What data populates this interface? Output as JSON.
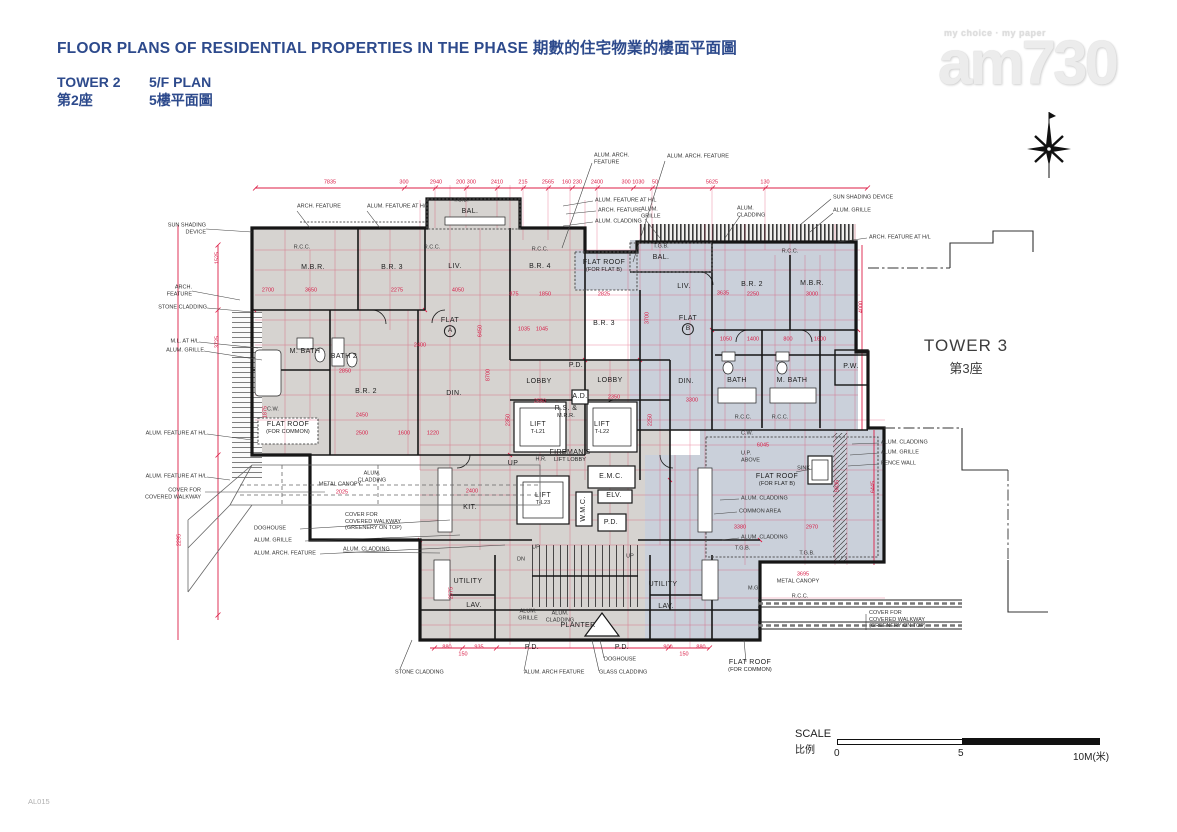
{
  "header": {
    "title": "FLOOR PLANS OF RESIDENTIAL PROPERTIES IN THE PHASE 期數的住宅物業的樓面平面圖",
    "tower_en": "TOWER 2",
    "plan_en": "5/F PLAN",
    "tower_zh": "第2座",
    "plan_zh": "5樓平面圖"
  },
  "logo": {
    "tagline": "my choice · my paper",
    "brand": "am730"
  },
  "tower3": {
    "en": "TOWER 3",
    "zh": "第3座"
  },
  "scale": {
    "label_en": "SCALE",
    "label_zh": "比例",
    "t0": "0",
    "t5": "5",
    "t10": "10M(米)"
  },
  "footer": {
    "code": "AL015"
  },
  "colors": {
    "accent_red": "#dc1e46",
    "title_blue": "#2d4a8c",
    "flat_a_fill": "#d6d3d0",
    "flat_b_fill": "#cad0da",
    "wall": "#161616"
  },
  "plan": {
    "rooms": [
      {
        "t": "M.B.R.",
        "x": 313,
        "y": 268
      },
      {
        "t": "B.R. 3",
        "x": 392,
        "y": 268
      },
      {
        "t": "LIV.",
        "x": 455,
        "y": 267
      },
      {
        "t": "BAL.",
        "x": 470,
        "y": 212
      },
      {
        "t": "B.R. 4",
        "x": 540,
        "y": 267
      },
      {
        "t": "FLAT",
        "c": "A",
        "x": 450,
        "y": 327
      },
      {
        "t": "M. BATH",
        "x": 305,
        "y": 352
      },
      {
        "t": "BATH 2",
        "x": 344,
        "y": 357
      },
      {
        "t": "B.R. 2",
        "x": 366,
        "y": 392
      },
      {
        "t": "DIN.",
        "x": 454,
        "y": 394
      },
      {
        "t": "KIT.",
        "x": 470,
        "y": 508
      },
      {
        "t": "LOBBY",
        "x": 539,
        "y": 382
      },
      {
        "t": "LOBBY",
        "x": 610,
        "y": 381
      },
      {
        "t": "P.D.",
        "x": 576,
        "y": 366
      },
      {
        "t": "A.D.",
        "x": 580,
        "y": 397
      },
      {
        "t": "R.S. &",
        "s": "M.R.R.",
        "x": 566,
        "y": 412
      },
      {
        "t": "LIFT",
        "s": "T-L21",
        "x": 538,
        "y": 428
      },
      {
        "t": "LIFT",
        "s": "T-L22",
        "x": 602,
        "y": 428
      },
      {
        "t": "FIREMAN'S",
        "s": "LIFT LOBBY",
        "x": 570,
        "y": 456
      },
      {
        "t": "LIFT",
        "s": "T-L23",
        "x": 543,
        "y": 499
      },
      {
        "t": "E.M.C.",
        "x": 611,
        "y": 477
      },
      {
        "t": "ELV.",
        "x": 614,
        "y": 496
      },
      {
        "t": "W.M.C.",
        "x": 584,
        "y": 509,
        "r": -90
      },
      {
        "t": "P.D.",
        "x": 611,
        "y": 523
      },
      {
        "t": "UP",
        "x": 513,
        "y": 464
      },
      {
        "t": "UTILITY",
        "x": 468,
        "y": 582
      },
      {
        "t": "LAV.",
        "x": 474,
        "y": 606
      },
      {
        "t": "UTILITY",
        "x": 663,
        "y": 585
      },
      {
        "t": "LAV.",
        "x": 666,
        "y": 607
      },
      {
        "t": "PLANTER",
        "x": 578,
        "y": 626
      },
      {
        "t": "P.D.",
        "x": 532,
        "y": 648
      },
      {
        "t": "P.D.",
        "x": 622,
        "y": 648
      },
      {
        "t": "BAL.",
        "x": 661,
        "y": 258
      },
      {
        "t": "LIV.",
        "x": 684,
        "y": 287
      },
      {
        "t": "B.R. 3",
        "x": 604,
        "y": 324
      },
      {
        "t": "FLAT",
        "c": "B",
        "x": 688,
        "y": 325
      },
      {
        "t": "B.R. 2",
        "x": 752,
        "y": 285
      },
      {
        "t": "M.B.R.",
        "x": 812,
        "y": 284
      },
      {
        "t": "DIN.",
        "x": 686,
        "y": 382
      },
      {
        "t": "BATH",
        "x": 737,
        "y": 381
      },
      {
        "t": "M. BATH",
        "x": 792,
        "y": 381
      },
      {
        "t": "P.W.",
        "x": 851,
        "y": 367
      },
      {
        "t": "FLAT ROOF",
        "s": "(FOR FLAT B)",
        "x": 604,
        "y": 266
      },
      {
        "t": "FLAT ROOF",
        "s": "(FOR FLAT B)",
        "x": 777,
        "y": 480
      },
      {
        "t": "FLAT ROOF",
        "s": "(FOR COMMON)",
        "x": 288,
        "y": 428
      },
      {
        "t": "FLAT ROOF",
        "s": "(FOR COMMON)",
        "x": 750,
        "y": 666
      }
    ],
    "annotations": [
      {
        "t": "SUN SHADING\nDEVICE",
        "x": 206,
        "y": 229,
        "a": "r"
      },
      {
        "t": "ARCH.\nFEATURE",
        "x": 192,
        "y": 291,
        "a": "r"
      },
      {
        "t": "STONE CLADDING",
        "x": 207,
        "y": 308,
        "a": "r"
      },
      {
        "t": "M.L. AT H/L",
        "x": 199,
        "y": 342,
        "a": "r"
      },
      {
        "t": "ALUM. GRILLE",
        "x": 204,
        "y": 351,
        "a": "r"
      },
      {
        "t": "ALUM. FEATURE AT H/L",
        "x": 207,
        "y": 434,
        "a": "r"
      },
      {
        "t": "ALUM. FEATURE AT H/L",
        "x": 207,
        "y": 477,
        "a": "r"
      },
      {
        "t": "COVER FOR\nCOVERED WALKWAY",
        "x": 201,
        "y": 494,
        "a": "r"
      },
      {
        "t": "DOGHOUSE",
        "x": 254,
        "y": 529,
        "a": "l"
      },
      {
        "t": "ALUM. GRILLE",
        "x": 254,
        "y": 541,
        "a": "l"
      },
      {
        "t": "ALUM. ARCH. FEATURE",
        "x": 254,
        "y": 554,
        "a": "l"
      },
      {
        "t": "ARCH. FEATURE",
        "x": 297,
        "y": 207,
        "a": "l"
      },
      {
        "t": "ALUM. FEATURE AT H/L",
        "x": 367,
        "y": 207,
        "a": "l"
      },
      {
        "t": "T.G.B.",
        "x": 461,
        "y": 201,
        "a": "c"
      },
      {
        "t": "ALUM. ARCH.\nFEATURE",
        "x": 594,
        "y": 159,
        "a": "l"
      },
      {
        "t": "ALUM. ARCH. FEATURE",
        "x": 667,
        "y": 157,
        "a": "l"
      },
      {
        "t": "ALUM. FEATURE AT H/L",
        "x": 595,
        "y": 201,
        "a": "l"
      },
      {
        "t": "ARCH. FEATURE",
        "x": 598,
        "y": 211,
        "a": "l"
      },
      {
        "t": "ALUM. CLADDING",
        "x": 595,
        "y": 222,
        "a": "l"
      },
      {
        "t": "ALUM.\nGRILLE",
        "x": 641,
        "y": 213,
        "a": "l"
      },
      {
        "t": "T.G.B.",
        "x": 661,
        "y": 247,
        "a": "c"
      },
      {
        "t": "ALUM.\nCLADDING",
        "x": 737,
        "y": 212,
        "a": "l"
      },
      {
        "t": "SUN SHADING DEVICE",
        "x": 833,
        "y": 198,
        "a": "l"
      },
      {
        "t": "ALUM. GRILLE",
        "x": 833,
        "y": 211,
        "a": "l"
      },
      {
        "t": "ARCH. FEATURE AT H/L",
        "x": 869,
        "y": 238,
        "a": "l"
      },
      {
        "t": "ALUM. CLADDING",
        "x": 881,
        "y": 443,
        "a": "l"
      },
      {
        "t": "ALUM. GRILLE",
        "x": 881,
        "y": 453,
        "a": "l"
      },
      {
        "t": "FENCE WALL",
        "x": 881,
        "y": 464,
        "a": "l"
      },
      {
        "t": "SINK",
        "x": 810,
        "y": 469,
        "a": "r"
      },
      {
        "t": "U.P.\nABOVE",
        "x": 741,
        "y": 457,
        "a": "l"
      },
      {
        "t": "ALUM. CLADDING",
        "x": 741,
        "y": 499,
        "a": "l"
      },
      {
        "t": "COMMON AREA",
        "x": 739,
        "y": 512,
        "a": "l"
      },
      {
        "t": "ALUM. CLADDING",
        "x": 741,
        "y": 538,
        "a": "l"
      },
      {
        "t": "T.G.B.",
        "x": 735,
        "y": 549,
        "a": "l"
      },
      {
        "t": "T.G.B.",
        "x": 807,
        "y": 554,
        "a": "c"
      },
      {
        "t": "METAL CANOPY",
        "x": 798,
        "y": 582,
        "a": "c"
      },
      {
        "t": "R.C.C.",
        "x": 800,
        "y": 597,
        "a": "c"
      },
      {
        "t": "M.G.",
        "x": 748,
        "y": 589,
        "a": "l"
      },
      {
        "t": "COVER FOR\nCOVERED WALKWAY\n(GREENERY ON TOP)",
        "x": 869,
        "y": 620,
        "a": "l"
      },
      {
        "t": "METAL CANOPY",
        "x": 340,
        "y": 485,
        "a": "c"
      },
      {
        "t": "ALUM.\nCLADDING",
        "x": 372,
        "y": 477,
        "a": "c"
      },
      {
        "t": "COVER FOR\nCOVERED WALKWAY\n(GREENERY ON TOP)",
        "x": 345,
        "y": 522,
        "a": "l"
      },
      {
        "t": "ALUM. CLADDING",
        "x": 343,
        "y": 550,
        "a": "l"
      },
      {
        "t": "STONE CLADDING",
        "x": 395,
        "y": 673,
        "a": "l"
      },
      {
        "t": "ALUM. ARCH FEATURE",
        "x": 524,
        "y": 673,
        "a": "l"
      },
      {
        "t": "DOGHOUSE",
        "x": 604,
        "y": 660,
        "a": "l"
      },
      {
        "t": "GLASS CLADDING",
        "x": 599,
        "y": 673,
        "a": "l"
      },
      {
        "t": "ALUM.\nGRILLE",
        "x": 528,
        "y": 615,
        "a": "c"
      },
      {
        "t": "ALUM.\nCLADDING",
        "x": 560,
        "y": 617,
        "a": "c"
      },
      {
        "t": "C.W.",
        "x": 273,
        "y": 410,
        "a": "c"
      },
      {
        "t": "C.W.",
        "x": 747,
        "y": 434,
        "a": "c"
      },
      {
        "t": "R.C.C.",
        "x": 302,
        "y": 248,
        "a": "c"
      },
      {
        "t": "R.C.C.",
        "x": 432,
        "y": 248,
        "a": "c"
      },
      {
        "t": "R.C.C.",
        "x": 540,
        "y": 250,
        "a": "c"
      },
      {
        "t": "R.C.C.",
        "x": 790,
        "y": 252,
        "a": "c"
      },
      {
        "t": "R.C.C.",
        "x": 743,
        "y": 418,
        "a": "c"
      },
      {
        "t": "R.C.C.",
        "x": 780,
        "y": 418,
        "a": "c"
      },
      {
        "t": "H.R.",
        "x": 541,
        "y": 460,
        "a": "c"
      },
      {
        "t": "UP",
        "x": 536,
        "y": 548,
        "a": "c"
      },
      {
        "t": "DN",
        "x": 521,
        "y": 560,
        "a": "c"
      },
      {
        "t": "UP",
        "x": 630,
        "y": 557,
        "a": "c"
      }
    ],
    "dims": [
      {
        "t": "7835",
        "x": 330,
        "y": 183
      },
      {
        "t": "300",
        "x": 404,
        "y": 183
      },
      {
        "t": "2940",
        "x": 436,
        "y": 183
      },
      {
        "t": "200 300",
        "x": 466,
        "y": 183
      },
      {
        "t": "2410",
        "x": 497,
        "y": 183
      },
      {
        "t": "215",
        "x": 523,
        "y": 183
      },
      {
        "t": "2565",
        "x": 548,
        "y": 183
      },
      {
        "t": "160 230",
        "x": 572,
        "y": 183
      },
      {
        "t": "2400",
        "x": 597,
        "y": 183
      },
      {
        "t": "300 1030",
        "x": 633,
        "y": 183
      },
      {
        "t": "50",
        "x": 655,
        "y": 183
      },
      {
        "t": "5625",
        "x": 712,
        "y": 183
      },
      {
        "t": "130",
        "x": 765,
        "y": 183
      },
      {
        "t": "2700",
        "x": 268,
        "y": 291
      },
      {
        "t": "3650",
        "x": 311,
        "y": 291
      },
      {
        "t": "2275",
        "x": 397,
        "y": 291
      },
      {
        "t": "4050",
        "x": 458,
        "y": 291
      },
      {
        "t": "875",
        "x": 514,
        "y": 295
      },
      {
        "t": "1850",
        "x": 545,
        "y": 295
      },
      {
        "t": "2825",
        "x": 604,
        "y": 295
      },
      {
        "t": "3635",
        "x": 723,
        "y": 294
      },
      {
        "t": "2250",
        "x": 753,
        "y": 295
      },
      {
        "t": "3000",
        "x": 812,
        "y": 295
      },
      {
        "t": "1525",
        "x": 218,
        "y": 258,
        "r": -90
      },
      {
        "t": "3725",
        "x": 218,
        "y": 342,
        "r": -90
      },
      {
        "t": "2295",
        "x": 180,
        "y": 540,
        "r": -90
      },
      {
        "t": "1875",
        "x": 266,
        "y": 412,
        "r": -90
      },
      {
        "t": "6450",
        "x": 481,
        "y": 331,
        "r": -90
      },
      {
        "t": "8700",
        "x": 489,
        "y": 375,
        "r": -90
      },
      {
        "t": "3700",
        "x": 648,
        "y": 318,
        "r": -90
      },
      {
        "t": "2350",
        "x": 509,
        "y": 420,
        "r": -90
      },
      {
        "t": "2250",
        "x": 651,
        "y": 420,
        "r": -90
      },
      {
        "t": "4000",
        "x": 862,
        "y": 307,
        "r": -90
      },
      {
        "t": "5835",
        "x": 838,
        "y": 486,
        "r": -90
      },
      {
        "t": "6445",
        "x": 874,
        "y": 487,
        "r": -90
      },
      {
        "t": "2575",
        "x": 452,
        "y": 593,
        "r": -90
      },
      {
        "t": "2400",
        "x": 420,
        "y": 346
      },
      {
        "t": "1035",
        "x": 524,
        "y": 330
      },
      {
        "t": "1045",
        "x": 542,
        "y": 330
      },
      {
        "t": "2850",
        "x": 345,
        "y": 372
      },
      {
        "t": "2450",
        "x": 362,
        "y": 416
      },
      {
        "t": "2500",
        "x": 362,
        "y": 434
      },
      {
        "t": "1600",
        "x": 404,
        "y": 434
      },
      {
        "t": "1220",
        "x": 433,
        "y": 434
      },
      {
        "t": "2550",
        "x": 540,
        "y": 402
      },
      {
        "t": "2350",
        "x": 614,
        "y": 398
      },
      {
        "t": "3300",
        "x": 692,
        "y": 401
      },
      {
        "t": "2400",
        "x": 472,
        "y": 492
      },
      {
        "t": "1050",
        "x": 726,
        "y": 340
      },
      {
        "t": "1400",
        "x": 753,
        "y": 340
      },
      {
        "t": "800",
        "x": 788,
        "y": 340
      },
      {
        "t": "1600",
        "x": 820,
        "y": 340
      },
      {
        "t": "6045",
        "x": 763,
        "y": 446
      },
      {
        "t": "3380",
        "x": 740,
        "y": 528
      },
      {
        "t": "2970",
        "x": 812,
        "y": 528
      },
      {
        "t": "3695",
        "x": 803,
        "y": 575
      },
      {
        "t": "2025",
        "x": 342,
        "y": 493
      },
      {
        "t": "880",
        "x": 447,
        "y": 648
      },
      {
        "t": "935",
        "x": 479,
        "y": 648
      },
      {
        "t": "150",
        "x": 463,
        "y": 655
      },
      {
        "t": "900",
        "x": 668,
        "y": 648
      },
      {
        "t": "880",
        "x": 701,
        "y": 648
      },
      {
        "t": "150",
        "x": 684,
        "y": 655
      }
    ]
  }
}
